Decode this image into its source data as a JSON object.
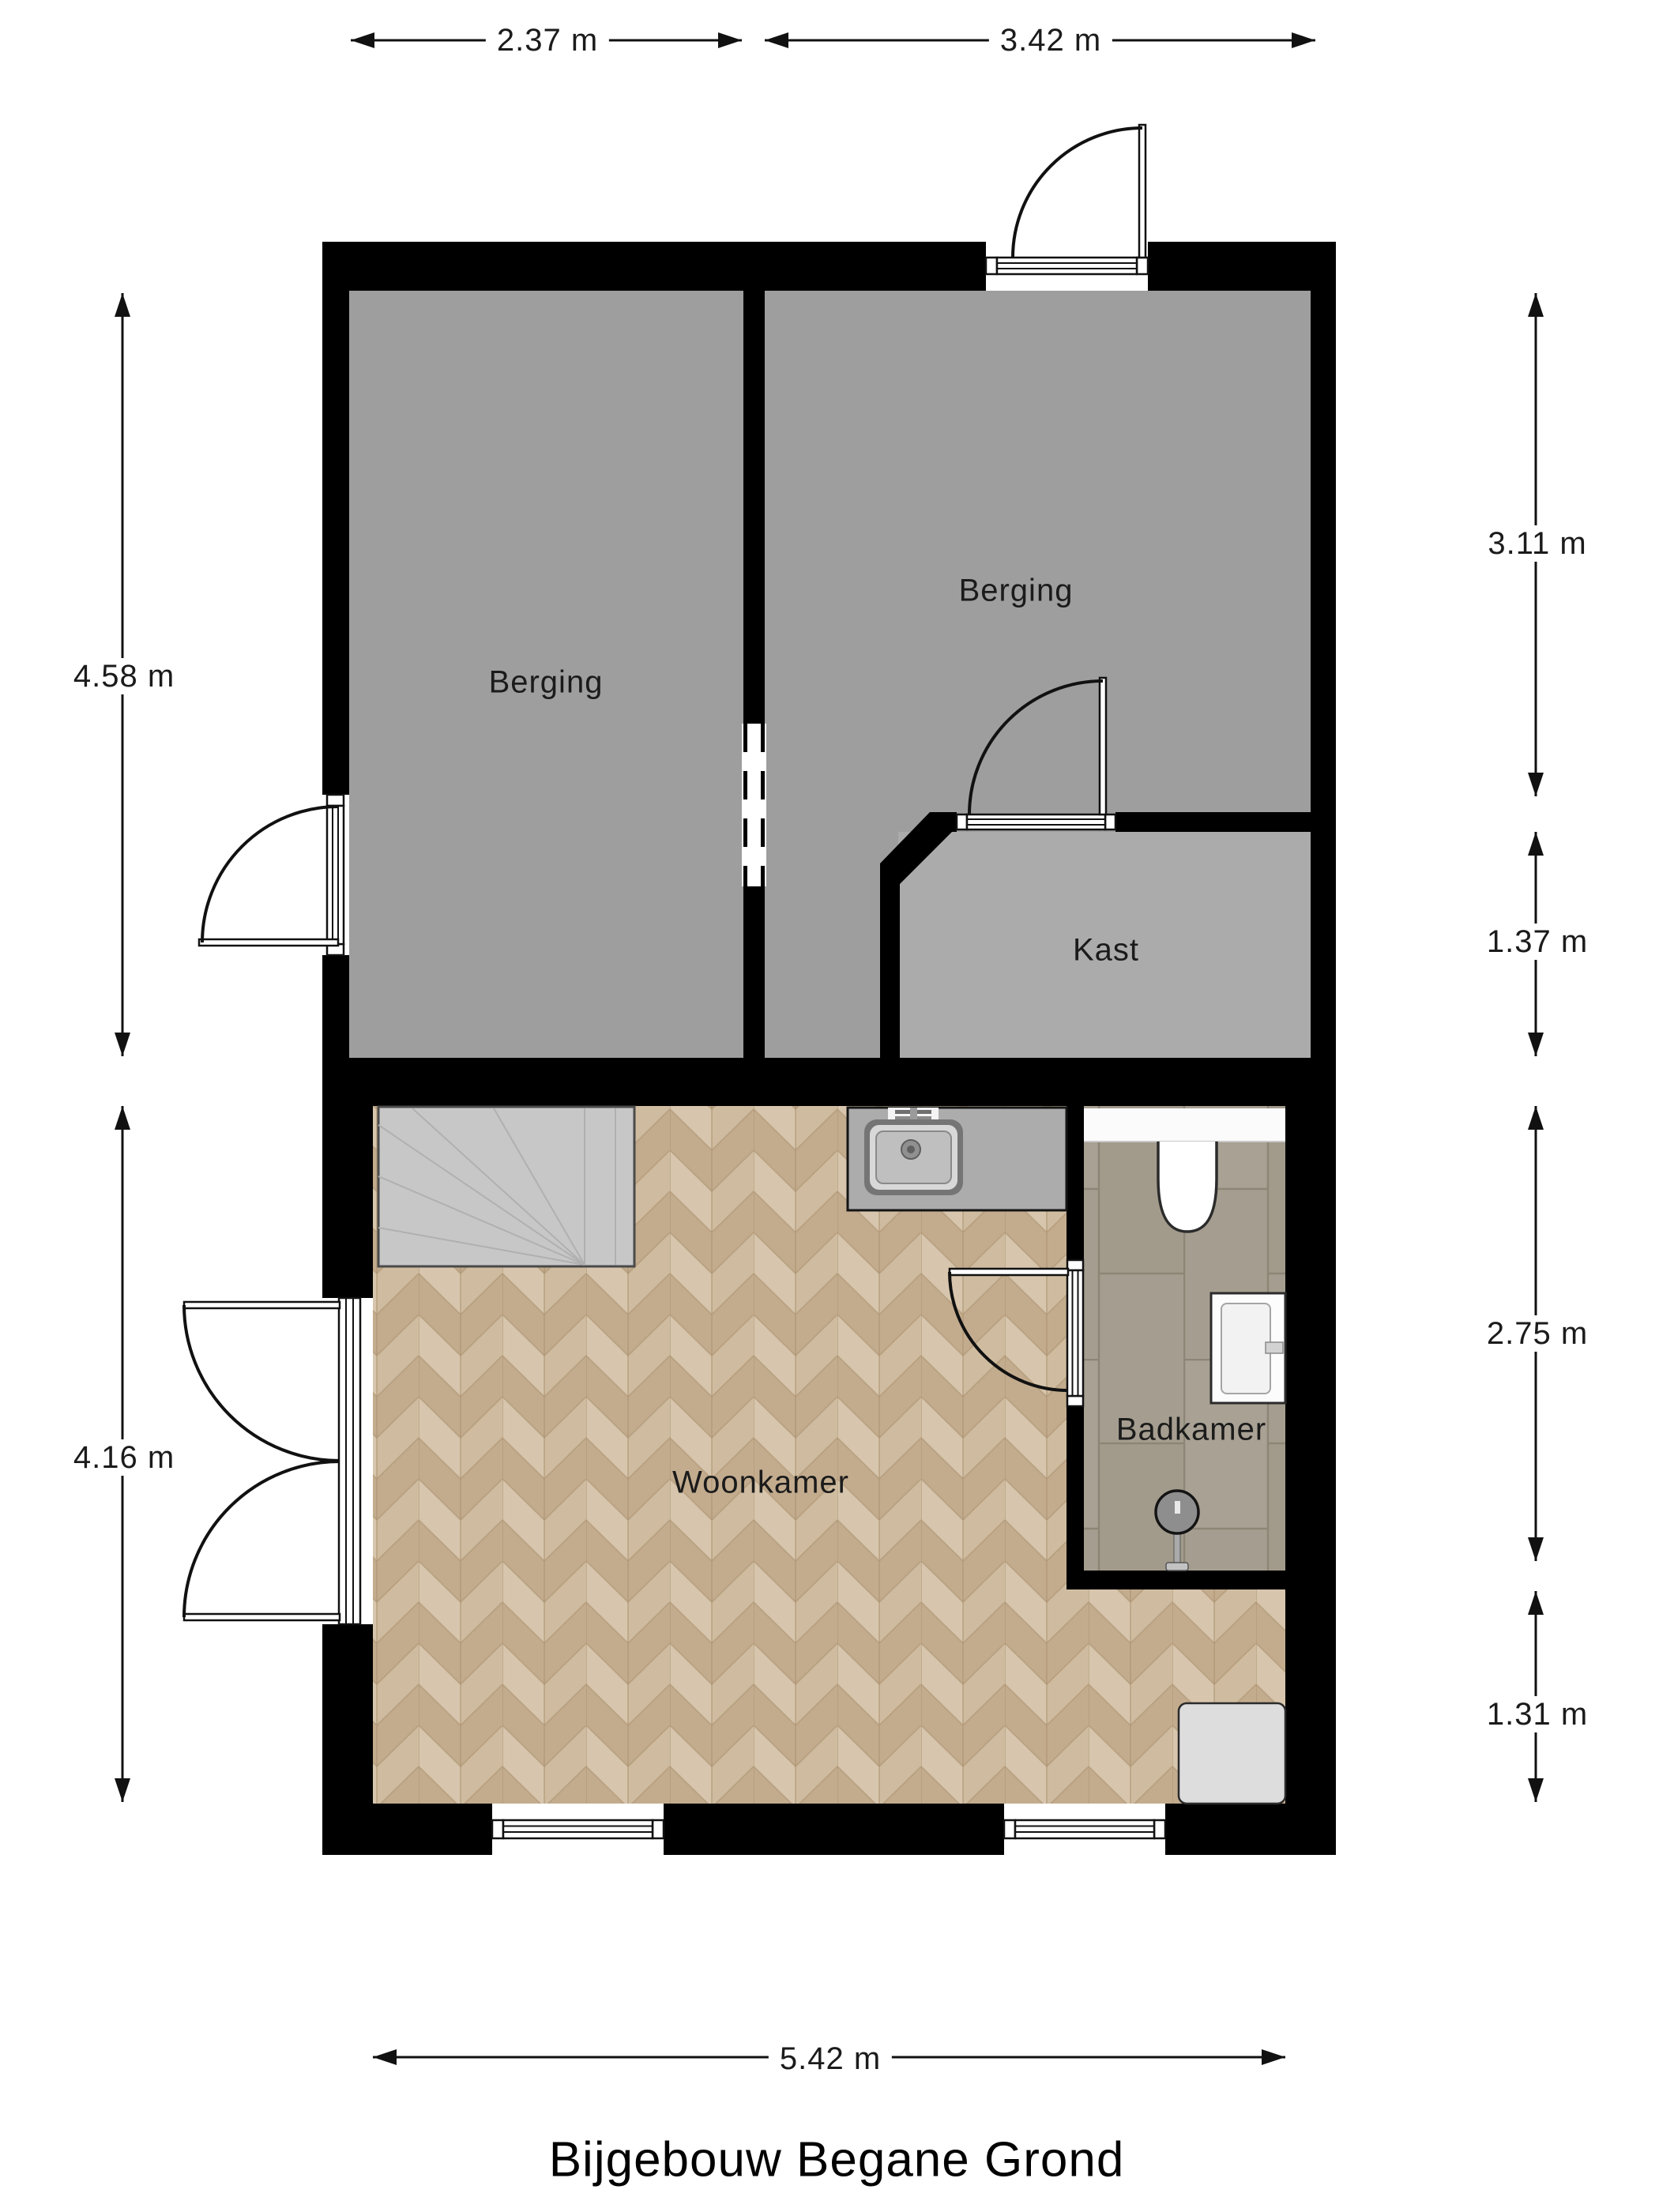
{
  "title": {
    "text": "Bijgebouw Begane Grond"
  },
  "rooms": {
    "berging_left": {
      "label": "Berging"
    },
    "berging_right": {
      "label": "Berging"
    },
    "kast": {
      "label": "Kast"
    },
    "woonkamer": {
      "label": "Woonkamer"
    },
    "badkamer": {
      "label": "Badkamer"
    }
  },
  "dimensions": {
    "top_left": {
      "label": "2.37 m"
    },
    "top_right": {
      "label": "3.42 m"
    },
    "left_upper": {
      "label": "4.58 m"
    },
    "left_lower": {
      "label": "4.16 m"
    },
    "right_1": {
      "label": "3.11 m"
    },
    "right_2": {
      "label": "1.37 m"
    },
    "right_3": {
      "label": "2.75 m"
    },
    "right_4": {
      "label": "1.31 m"
    },
    "bottom": {
      "label": "5.42 m"
    }
  },
  "colors": {
    "wall": "#000000",
    "berging_floor": "#9e9e9e",
    "kast_floor": "#ababab",
    "wood_light": "#d7c6ad",
    "wood_dark": "#c3ac8e",
    "tile": "#a59e90",
    "stairs": "#c7c7c7",
    "fixture_white": "#ffffff",
    "text": "#1b1b1b"
  }
}
